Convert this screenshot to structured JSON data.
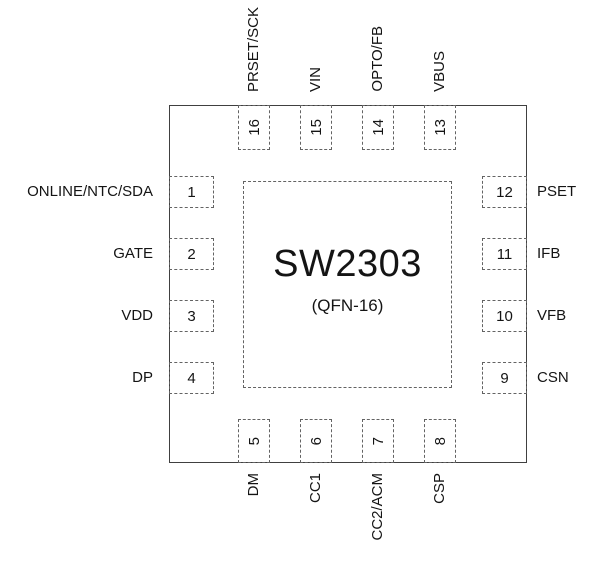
{
  "chip": {
    "name": "SW2303",
    "package": "(QFN-16)"
  },
  "pins": {
    "left": [
      {
        "number": "1",
        "label": "ONLINE/NTC/SDA"
      },
      {
        "number": "2",
        "label": "GATE"
      },
      {
        "number": "3",
        "label": "VDD"
      },
      {
        "number": "4",
        "label": "DP"
      }
    ],
    "bottom": [
      {
        "number": "5",
        "label": "DM"
      },
      {
        "number": "6",
        "label": "CC1"
      },
      {
        "number": "7",
        "label": "CC2/ACM"
      },
      {
        "number": "8",
        "label": "CSP"
      }
    ],
    "right": [
      {
        "number": "12",
        "label": "PSET"
      },
      {
        "number": "11",
        "label": "IFB"
      },
      {
        "number": "10",
        "label": "VFB"
      },
      {
        "number": "9",
        "label": "CSN"
      }
    ],
    "top": [
      {
        "number": "16",
        "label": "PRSET/SCK"
      },
      {
        "number": "15",
        "label": "VIN"
      },
      {
        "number": "14",
        "label": "OPTO/FB"
      },
      {
        "number": "13",
        "label": "VBUS"
      }
    ]
  },
  "colors": {
    "line": "#404040",
    "dash": "#636363",
    "text": "#141414"
  }
}
